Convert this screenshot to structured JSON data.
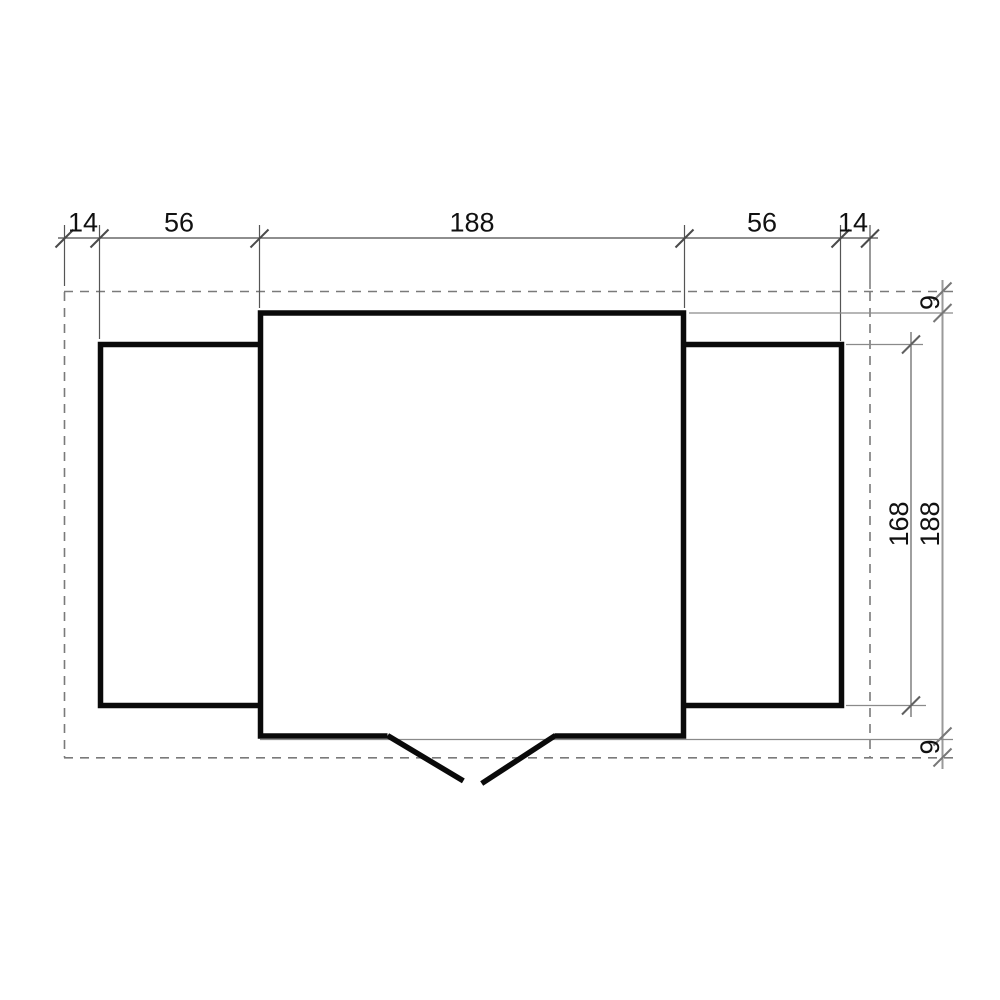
{
  "drawing": {
    "type": "floor-plan",
    "colors": {
      "wall_line": "#0a0a0a",
      "dimension_line": "#555555",
      "overhang_dashed_line": "#7a7a7a",
      "label_text": "#111111",
      "background": "#ffffff"
    },
    "dimensions": {
      "top": [
        "14",
        "56",
        "188",
        "56",
        "14"
      ],
      "right": [
        "9",
        "168",
        "188",
        "9"
      ]
    }
  }
}
